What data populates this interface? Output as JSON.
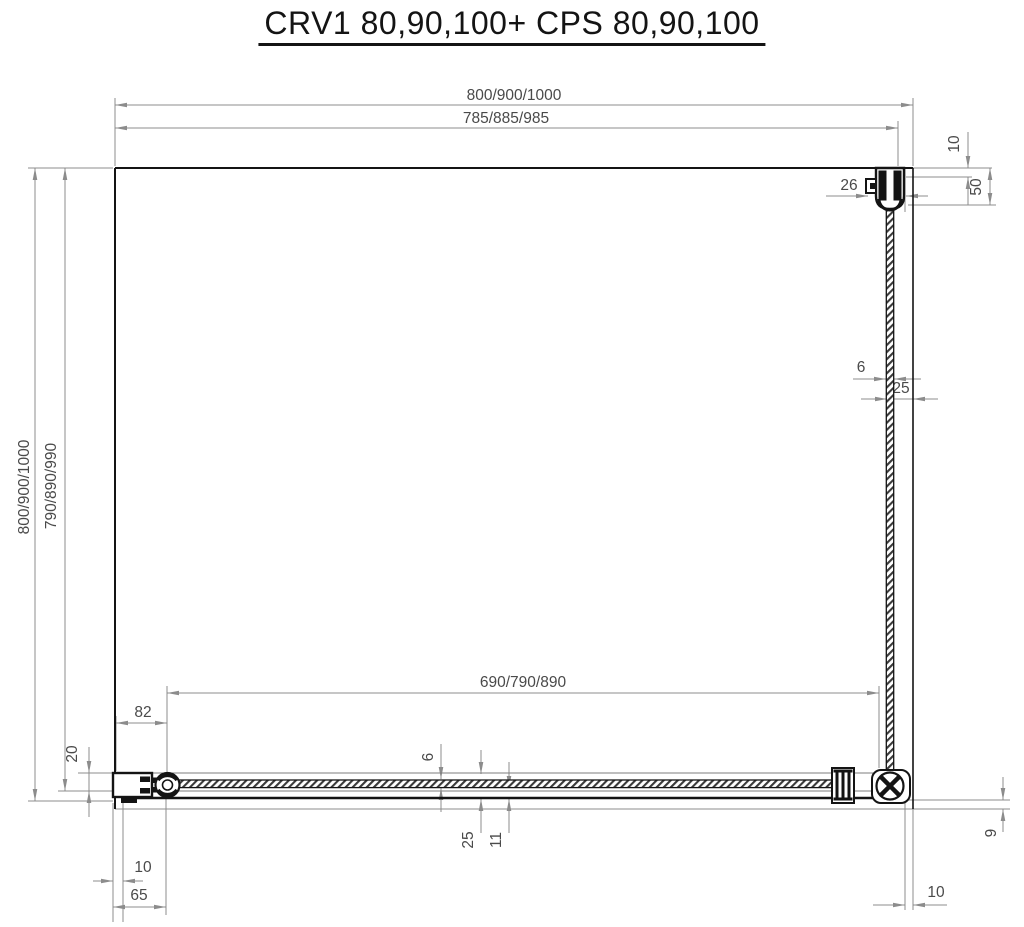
{
  "title": "CRV1 80,90,100+ CPS 80,90,100",
  "colors": {
    "ink": "#141414",
    "dim_line": "#8c8c8c",
    "dim_text": "#4a4a4a",
    "background": "#ffffff"
  },
  "dimensions": {
    "top_outer_width": "800/900/1000",
    "top_glass_width": "785/885/985",
    "left_outer_depth": "800/900/1000",
    "left_inner_depth": "790/890/990",
    "door_glass_width": "690/790/890",
    "hinge_offset": "82",
    "wall_profile_height": "20",
    "bracket_width": "26",
    "wall_to_glass_gap": "10",
    "bracket_length": "50",
    "side_glass_thickness": "6",
    "side_glass_to_wall": "25",
    "door_glass_thickness": "6",
    "door_profile_height": "25",
    "door_rail_height": "11",
    "left_wall_profile_width": "10",
    "hinge_center_distance": "65",
    "right_wall_profile_width": "10",
    "threshold_height": "9"
  }
}
